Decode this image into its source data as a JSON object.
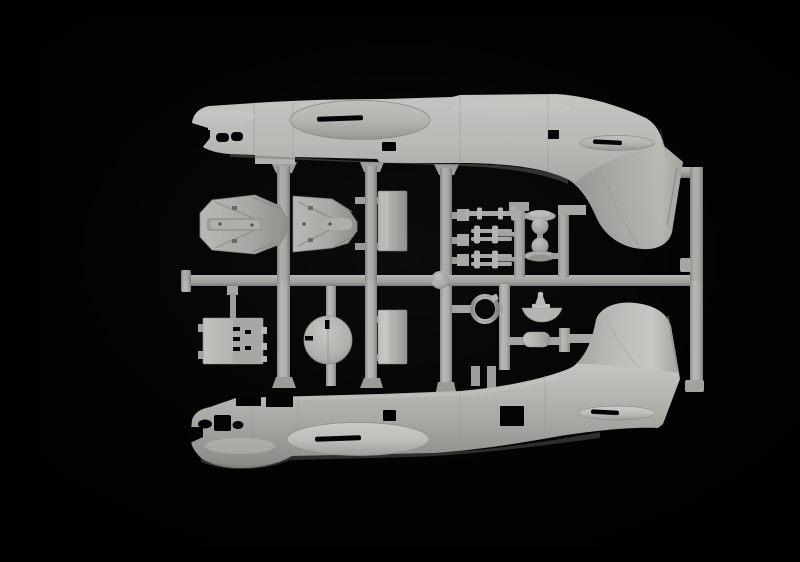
{
  "scene": {
    "description": "Photograph of a grey injection-moulded model kit sprue: two seaplane fuselage halves (noses left, tail fins facing inward) with small detail parts and runners between them, on a black background",
    "kit_subject": "flying-boat fuselage sprue"
  },
  "colors": {
    "background": "#000000",
    "plastic_highlight": "#d2d1cd",
    "plastic_light": "#c6c5c1",
    "plastic_base": "#b3b2ae",
    "plastic_mid": "#a4a39f",
    "plastic_shadow": "#8c8b87",
    "plastic_dark": "#706f6b",
    "cutout": "#040404"
  },
  "parts": [
    {
      "id": "fuselage-upper",
      "label": "upper fuselage half, nose left, fin pointing down"
    },
    {
      "id": "fuselage-lower",
      "label": "lower fuselage half, nose left, fin pointing up"
    },
    {
      "id": "float-half-left",
      "label": "wingtip float half with ribs"
    },
    {
      "id": "float-half-right",
      "label": "wingtip float half with ribs"
    },
    {
      "id": "floor-panel-upper",
      "label": "rectangular floor panel"
    },
    {
      "id": "floor-panel-lower",
      "label": "rectangular floor panel"
    },
    {
      "id": "bulkhead-panel",
      "label": "flat bulkhead panel with slots"
    },
    {
      "id": "bulkhead-disc",
      "label": "circular bulkhead disc with slots"
    },
    {
      "id": "strut-parts",
      "label": "three small strut and axle parts"
    },
    {
      "id": "dome-parts",
      "label": "two domed turret parts with flanges"
    },
    {
      "id": "ring-part",
      "label": "small ring part"
    },
    {
      "id": "fairing-part",
      "label": "curved fairing with cone"
    },
    {
      "id": "capsule-part",
      "label": "small rounded box part"
    },
    {
      "id": "runners",
      "label": "sprue runner frame"
    }
  ],
  "counts": {
    "fuselage_halves": 2,
    "small_parts": 12
  }
}
